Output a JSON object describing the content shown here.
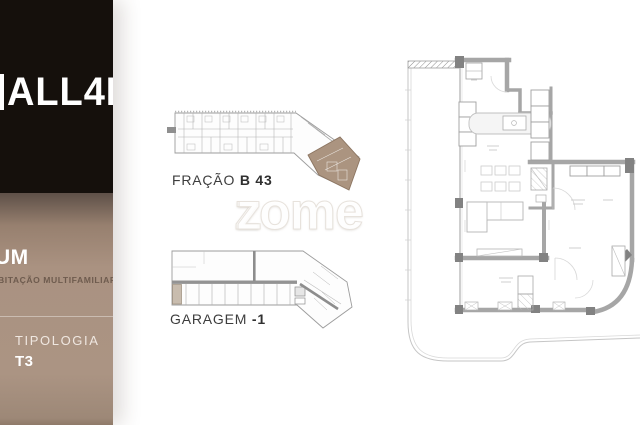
{
  "sidebar": {
    "brand": "ALL4K",
    "project_name": "UM",
    "project_subtitle": "BITAÇÃO MULTIFAMILIAR",
    "tipologia_label": "TIPOLOGIA",
    "tipologia_value": "T3"
  },
  "plans": {
    "fracao": {
      "label_prefix": "FRAÇÃO ",
      "label_bold": "B 43"
    },
    "garagem": {
      "label_prefix": "GARAGEM ",
      "label_bold": "-1"
    }
  },
  "watermark": {
    "overlap_letter": "z",
    "text": "zome"
  },
  "colors": {
    "brand_box": "#15100c",
    "info_panel": "#ab9483",
    "subtitle_text": "#6e5b4e",
    "highlight_tan": "#ab9480",
    "garage_stall_tan": "#c8bcae",
    "plan_wall_gray": "#a2a2a2",
    "caption_text": "#3d3d3d"
  }
}
